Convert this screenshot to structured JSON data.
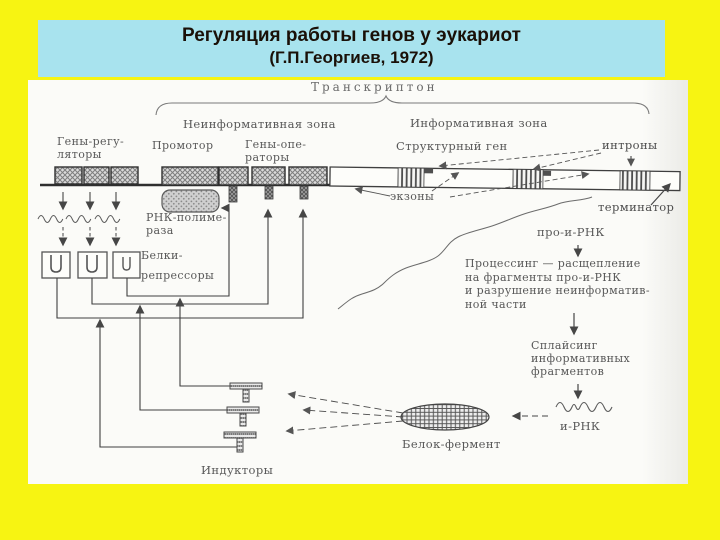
{
  "colors": {
    "background": "#f7f412",
    "title_box": "#a8e3ee",
    "title_text": "#1a1008",
    "panel": "#fbfbf8",
    "ink": "#4e4e4e"
  },
  "title": {
    "line1": "Регуляция работы генов у эукариот",
    "line2": "(Г.П.Георгиев, 1972)"
  },
  "diagram": {
    "labels": {
      "transcripton": "Транскриптон",
      "noninformative_zone": "Неинформативная зона",
      "informative_zone": "Информативная зона",
      "regulator_genes_l1": "Гены-регу-",
      "regulator_genes_l2": "ляторы",
      "promoter": "Промотор",
      "operator_genes_l1": "Гены-опе-",
      "operator_genes_l2": "раторы",
      "structural_gene": "Структурный ген",
      "introns": "интроны",
      "exons": "экзоны",
      "terminator": "терминатор",
      "pro_mrna": "про-и-РНК",
      "processing_l1": "Процессинг — расщепление",
      "processing_l2": "на фрагменты про-и-РНК",
      "processing_l3": "и разрушение неинформатив-",
      "processing_l4": "ной части",
      "splicing_l1": "Сплайсинг",
      "splicing_l2": "информативных",
      "splicing_l3": "фрагментов",
      "mrna": "и-РНК",
      "protein_enzyme": "Белок-фермент",
      "inducers": "Индукторы",
      "rna_polymerase_l1": "РНК-полиме-",
      "rna_polymerase_l2": "раза",
      "repressors_l1": "Белки-",
      "repressors_l2": "репрессоры"
    }
  }
}
